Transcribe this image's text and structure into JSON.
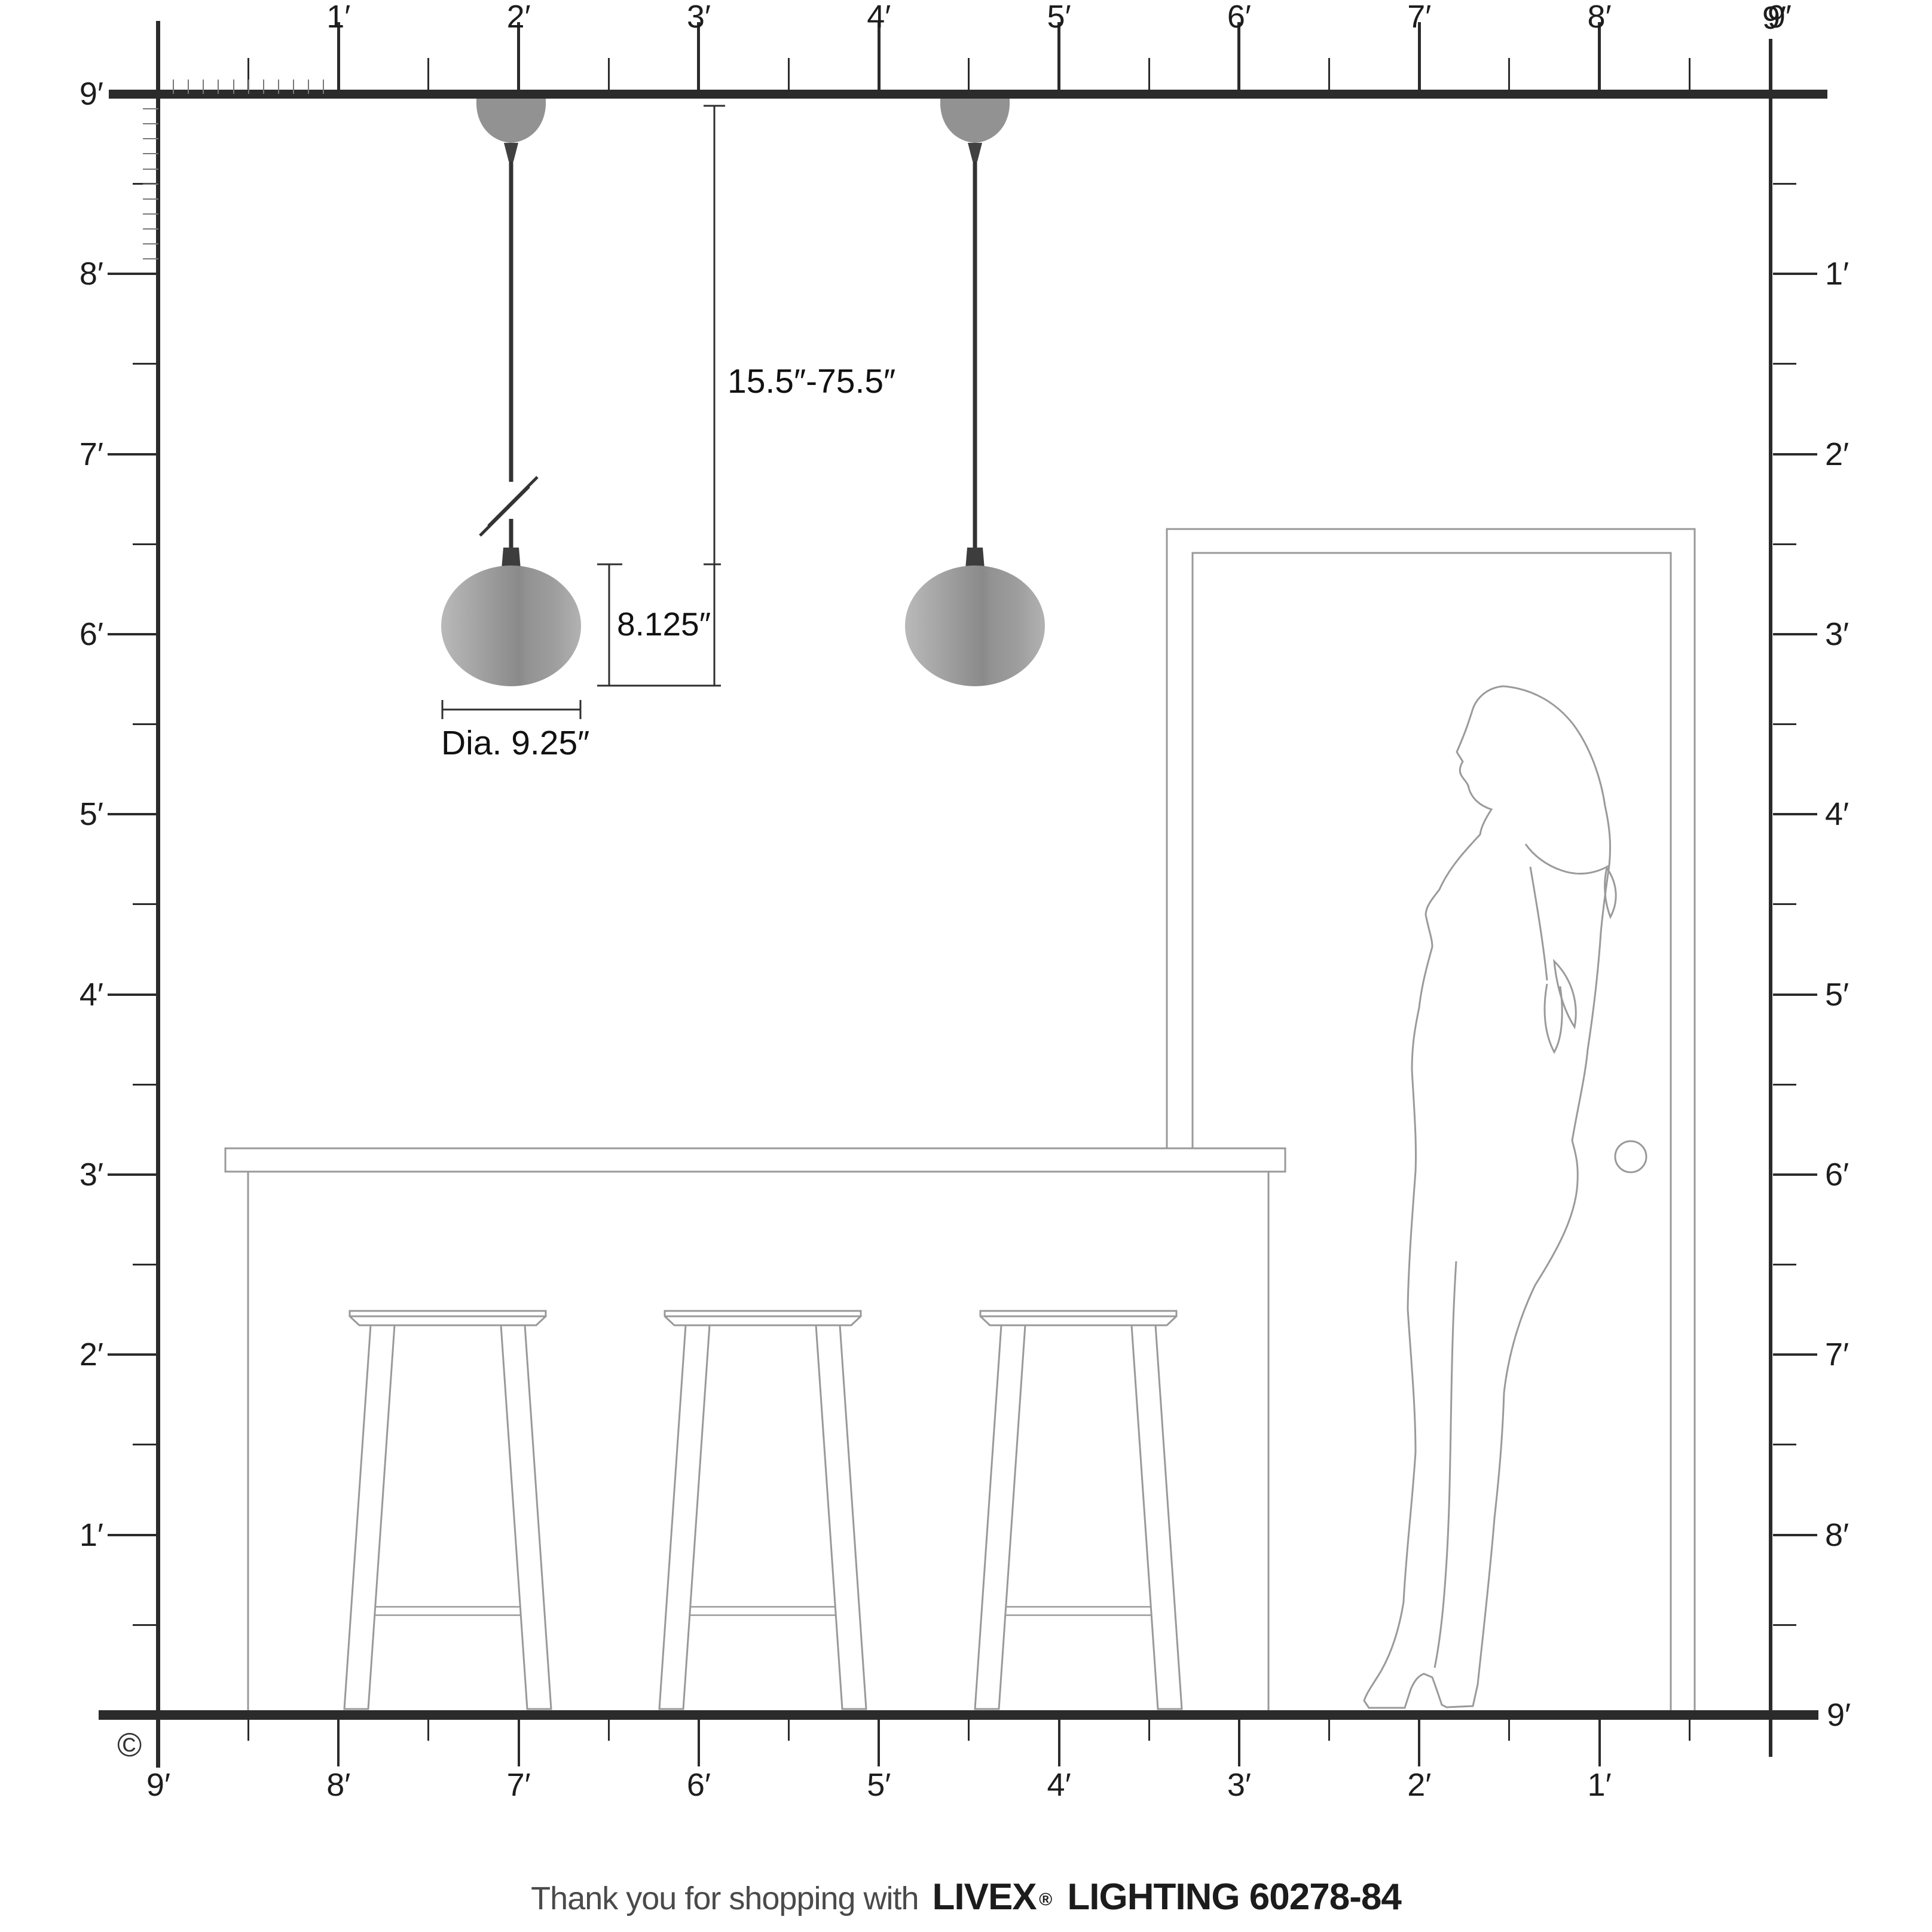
{
  "rulers": {
    "top": {
      "labels": [
        "1′",
        "2′",
        "3′",
        "4′",
        "5′",
        "6′",
        "7′",
        "8′",
        "9′"
      ]
    },
    "left": {
      "labels": [
        "9′",
        "8′",
        "7′",
        "6′",
        "5′",
        "4′",
        "3′",
        "2′",
        "1′"
      ]
    },
    "right": {
      "labels": [
        "9′",
        "1′",
        "2′",
        "3′",
        "4′",
        "5′",
        "6′",
        "7′",
        "8′",
        "9′"
      ]
    },
    "bottom": {
      "labels": [
        "9′",
        "8′",
        "7′",
        "6′",
        "5′",
        "4′",
        "3′",
        "2′",
        "1′"
      ]
    }
  },
  "annotations": {
    "hang_range": "15.5″-75.5″",
    "shade_height": "8.125″",
    "shade_diameter": "Dia. 9.25″"
  },
  "footer": {
    "prefix": "Thank you for shopping with",
    "brand": "LIVEX",
    "registered": "®",
    "suffix": "LIGHTING 60278-84"
  },
  "copyright_symbol": "©",
  "colors": {
    "ruler_line": "#2b2b2b",
    "artwork_line": "#999999",
    "cord": "#333333",
    "shade_light": "#b7b7b7",
    "shade_dark": "#8c8c8c",
    "canopy": "#929292"
  }
}
